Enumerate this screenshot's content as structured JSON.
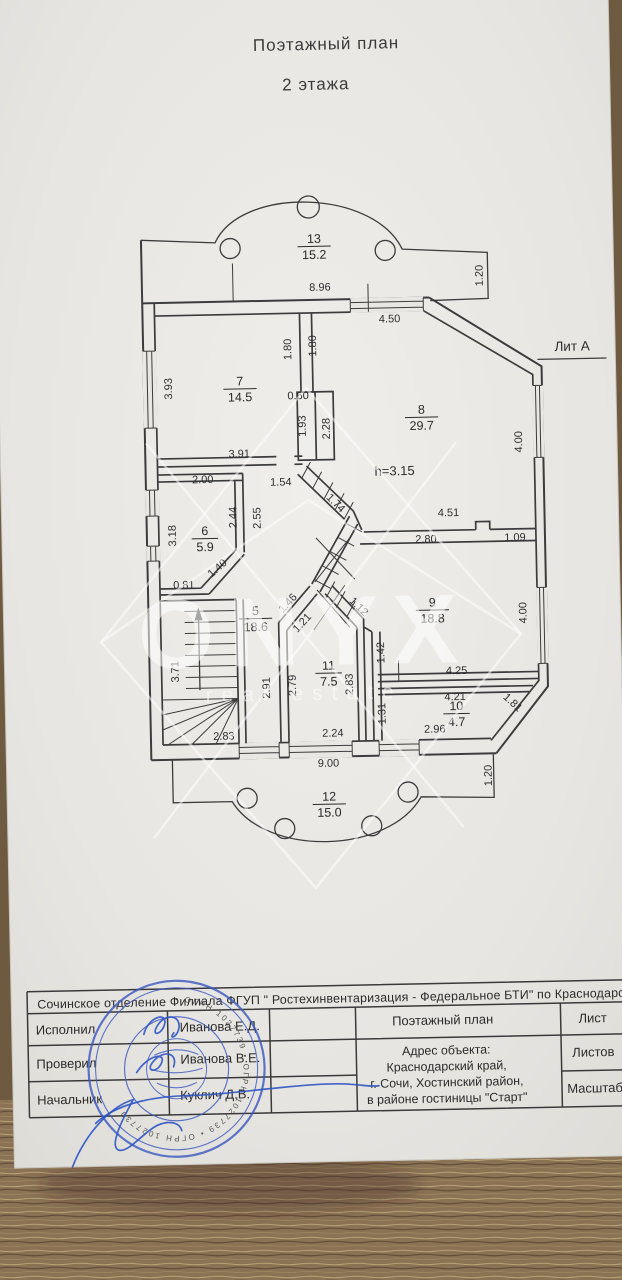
{
  "title": {
    "line1": "Поэтажный  план",
    "line2": "2 этажа"
  },
  "plan": {
    "liter_label": "Лит  А",
    "ceiling_height": "h=3.15",
    "rooms": [
      {
        "n": "13",
        "a": "15.2",
        "x": 322,
        "y": 243
      },
      {
        "n": "7",
        "a": "14.5",
        "x": 245,
        "y": 384
      },
      {
        "n": "8",
        "a": "29.7",
        "x": 426,
        "y": 416
      },
      {
        "n": "6",
        "a": "5.9",
        "x": 207,
        "y": 533
      },
      {
        "n": "5",
        "a": "18.6",
        "x": 256,
        "y": 614
      },
      {
        "n": "9",
        "a": "18.8",
        "x": 433,
        "y": 609
      },
      {
        "n": "11",
        "a": "7.5",
        "x": 328,
        "y": 670
      },
      {
        "n": "10",
        "a": "4.7",
        "x": 455,
        "y": 713
      },
      {
        "n": "12",
        "a": "15.0",
        "x": 326,
        "y": 801
      }
    ],
    "dims": [
      {
        "t": "8.96",
        "x": 327,
        "y": 291,
        "r": 0
      },
      {
        "t": "1.20",
        "x": 490,
        "y": 279,
        "r": -90
      },
      {
        "t": "4.50",
        "x": 396,
        "y": 324,
        "r": 0
      },
      {
        "t": "1.80",
        "x": 297,
        "y": 349,
        "r": -90
      },
      {
        "t": "1.80",
        "x": 322,
        "y": 346,
        "r": -90
      },
      {
        "t": "3.93",
        "x": 177,
        "y": 386,
        "r": -90
      },
      {
        "t": "0.60",
        "x": 303,
        "y": 399,
        "r": 0
      },
      {
        "t": "1.93",
        "x": 310,
        "y": 426,
        "r": -90
      },
      {
        "t": "2.28",
        "x": 334,
        "y": 429,
        "r": -90
      },
      {
        "t": "4.00",
        "x": 526,
        "y": 446,
        "r": -90
      },
      {
        "t": "3.91",
        "x": 243,
        "y": 456,
        "r": 0
      },
      {
        "t": "2.00",
        "x": 206,
        "y": 481,
        "r": 0
      },
      {
        "t": "1.54",
        "x": 284,
        "y": 485,
        "r": 0
      },
      {
        "t": "2.44",
        "x": 239,
        "y": 516,
        "r": -90
      },
      {
        "t": "2.55",
        "x": 263,
        "y": 517,
        "r": -90
      },
      {
        "t": "1.74",
        "x": 336,
        "y": 506,
        "r": 46
      },
      {
        "t": "3.18",
        "x": 178,
        "y": 533,
        "r": -90
      },
      {
        "t": "4.51",
        "x": 451,
        "y": 519,
        "r": 0
      },
      {
        "t": "2.80",
        "x": 428,
        "y": 545,
        "r": 0
      },
      {
        "t": "1.09",
        "x": 517,
        "y": 545,
        "r": 0
      },
      {
        "t": "1.40",
        "x": 221,
        "y": 569,
        "r": -40
      },
      {
        "t": "0.81",
        "x": 185,
        "y": 586,
        "r": 0
      },
      {
        "t": "1.46",
        "x": 291,
        "y": 605,
        "r": -46
      },
      {
        "t": "1.21",
        "x": 305,
        "y": 625,
        "r": -46
      },
      {
        "t": "1.12",
        "x": 357,
        "y": 610,
        "r": 46
      },
      {
        "t": "4.00",
        "x": 527,
        "y": 617,
        "r": -90
      },
      {
        "t": "3.71",
        "x": 178,
        "y": 669,
        "r": -90
      },
      {
        "t": "2.91",
        "x": 269,
        "y": 687,
        "r": -90
      },
      {
        "t": "2.79",
        "x": 295,
        "y": 685,
        "r": -90
      },
      {
        "t": "1.42",
        "x": 384,
        "y": 654,
        "r": -90
      },
      {
        "t": "2.83",
        "x": 352,
        "y": 685,
        "r": -90
      },
      {
        "t": "4.25",
        "x": 456,
        "y": 677,
        "r": 0
      },
      {
        "t": "4.21",
        "x": 454,
        "y": 703,
        "r": 0
      },
      {
        "t": "1.31",
        "x": 384,
        "y": 715,
        "r": -90
      },
      {
        "t": "2.96",
        "x": 433,
        "y": 735,
        "r": 0
      },
      {
        "t": "1.81",
        "x": 509,
        "y": 709,
        "r": 44
      },
      {
        "t": "2.83",
        "x": 222,
        "y": 738,
        "r": 0
      },
      {
        "t": "2.24",
        "x": 331,
        "y": 737,
        "r": 0
      },
      {
        "t": "9.00",
        "x": 326,
        "y": 767,
        "r": 0
      },
      {
        "t": "1.20",
        "x": 489,
        "y": 779,
        "r": -90
      }
    ]
  },
  "watermark": {
    "line1": "ONYX",
    "line2": "real estate"
  },
  "titleblock": {
    "org": "Сочинское отделение Филиала ФГУП \" Ростехинвентаризация - Федеральное БТИ\" по Краснодарскому",
    "rows": [
      {
        "role": "Исполнил",
        "name": "Иванова  Е.Д."
      },
      {
        "role": "Проверил",
        "name": "Иванова  В.Е."
      },
      {
        "role": "Начальник",
        "name": "Куклич Д.В."
      }
    ],
    "doc_title": "Поэтажный  план",
    "address": {
      "label": "Адрес  объекта:",
      "lines": [
        "Краснодарский край,",
        "г. Сочи, Хостинский район,",
        "в районе гостиницы \"Старт\""
      ]
    },
    "sheet_label": "Лист",
    "sheets_label": "Листов",
    "scale_label": "Масштаб",
    "stamp_text": "ОГРН 1027739"
  }
}
